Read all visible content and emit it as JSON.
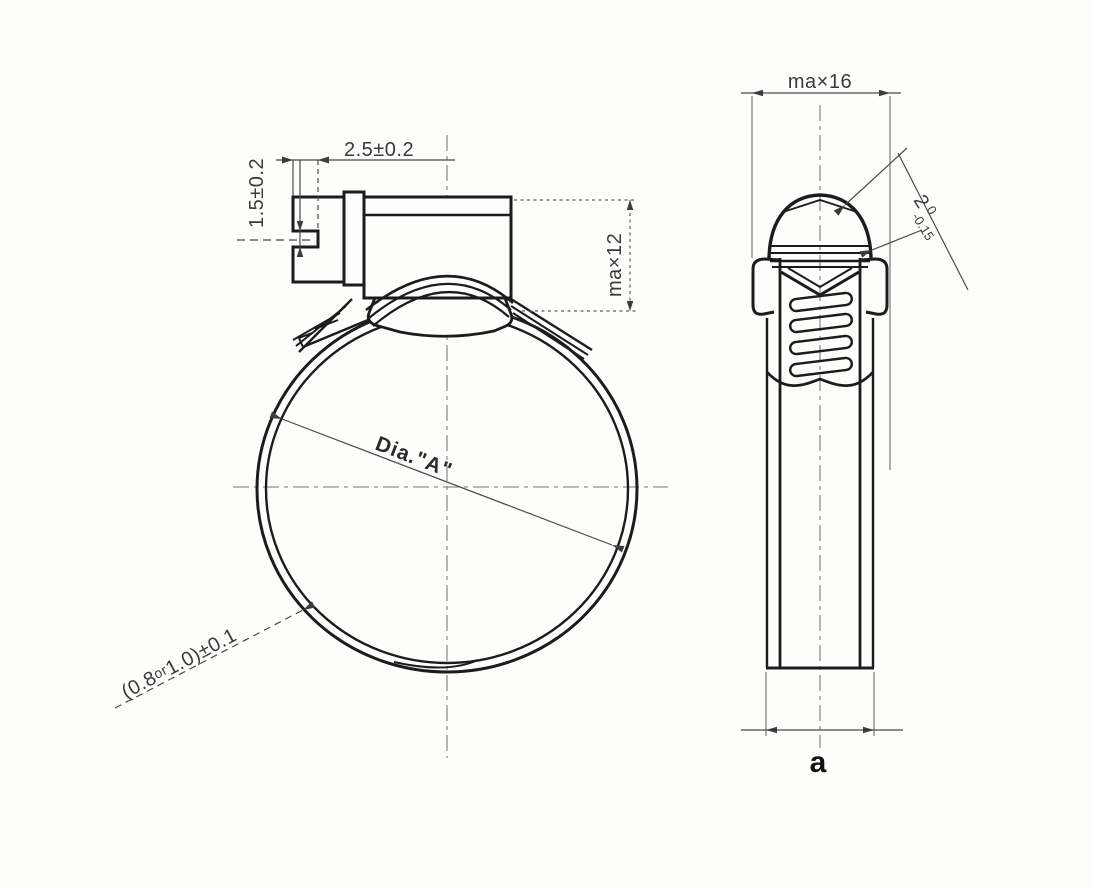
{
  "meta": {
    "title": "Hose clamp technical drawing",
    "background": "#fdfdfc",
    "line_color": "#1c1c1c",
    "dimension_color": "#4a4a4a",
    "centerline_color": "#8f8f8f"
  },
  "front_view": {
    "dim_slot_depth": "2.5±0.2",
    "dim_slot_width": "1.5±0.2",
    "dim_housing_height": "ma×12",
    "diameter_label": "Dia.\"A\"",
    "band_thickness_prefix": "(0.8",
    "band_thickness_or": "or",
    "band_thickness_suffix": "1.0)±0.1"
  },
  "side_view": {
    "dim_band_width": "ma×16",
    "dim_thickness_value": "2",
    "dim_thickness_tol_upper": "0",
    "dim_thickness_tol_lower": "-0.15",
    "view_label": "a"
  }
}
